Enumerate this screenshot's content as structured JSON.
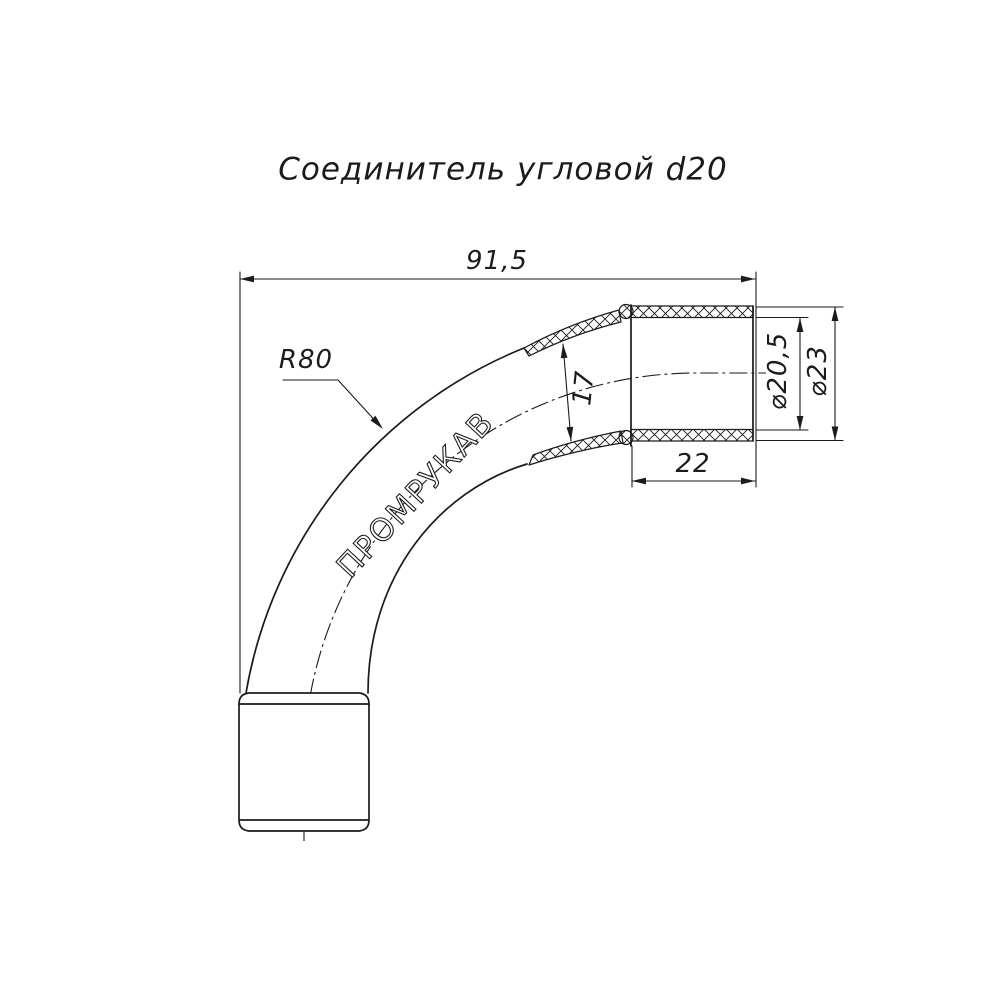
{
  "title": "Соединитель угловой d20",
  "brand_label": "ПРОМРУКАВ",
  "dimensions": {
    "overall_length": "91,5",
    "bend_radius": "R80",
    "bore_diameter": "17",
    "socket_inner_diameter": "⌀20,5",
    "socket_outer_diameter": "⌀23",
    "socket_length": "22"
  },
  "colors": {
    "line": "#1b1b1b",
    "background": "#ffffff"
  }
}
